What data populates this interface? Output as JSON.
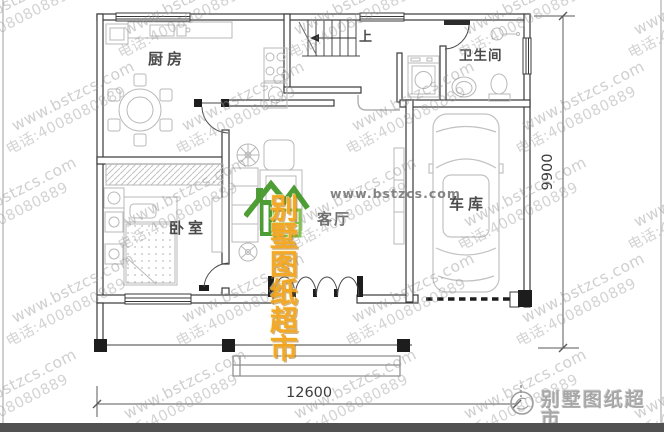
{
  "plan": {
    "labels": {
      "kitchen": "厨房",
      "bathroom": "卫生间",
      "garage": "车库",
      "bedroom": "卧室",
      "living": "客厅",
      "stairs_up": "上"
    },
    "dimensions": {
      "width": "12600",
      "height": "9900"
    }
  },
  "watermark": {
    "site": "www.bstzcs.com",
    "phone": "电话:4008080889"
  },
  "center_logo": {
    "site": "www.bstzcs.com",
    "name": "别墅图纸超市"
  },
  "footer_logo": {
    "name": "别墅图纸超市"
  },
  "colors": {
    "logo_orange": "#f3a51b",
    "logo_green_dark": "#45982b",
    "logo_green_light": "#7cc242",
    "watermark_gray": "#969696",
    "wall_line": "#3a3a3a",
    "furniture_line": "#b8b8b8",
    "bottom_bar": "#515151"
  }
}
